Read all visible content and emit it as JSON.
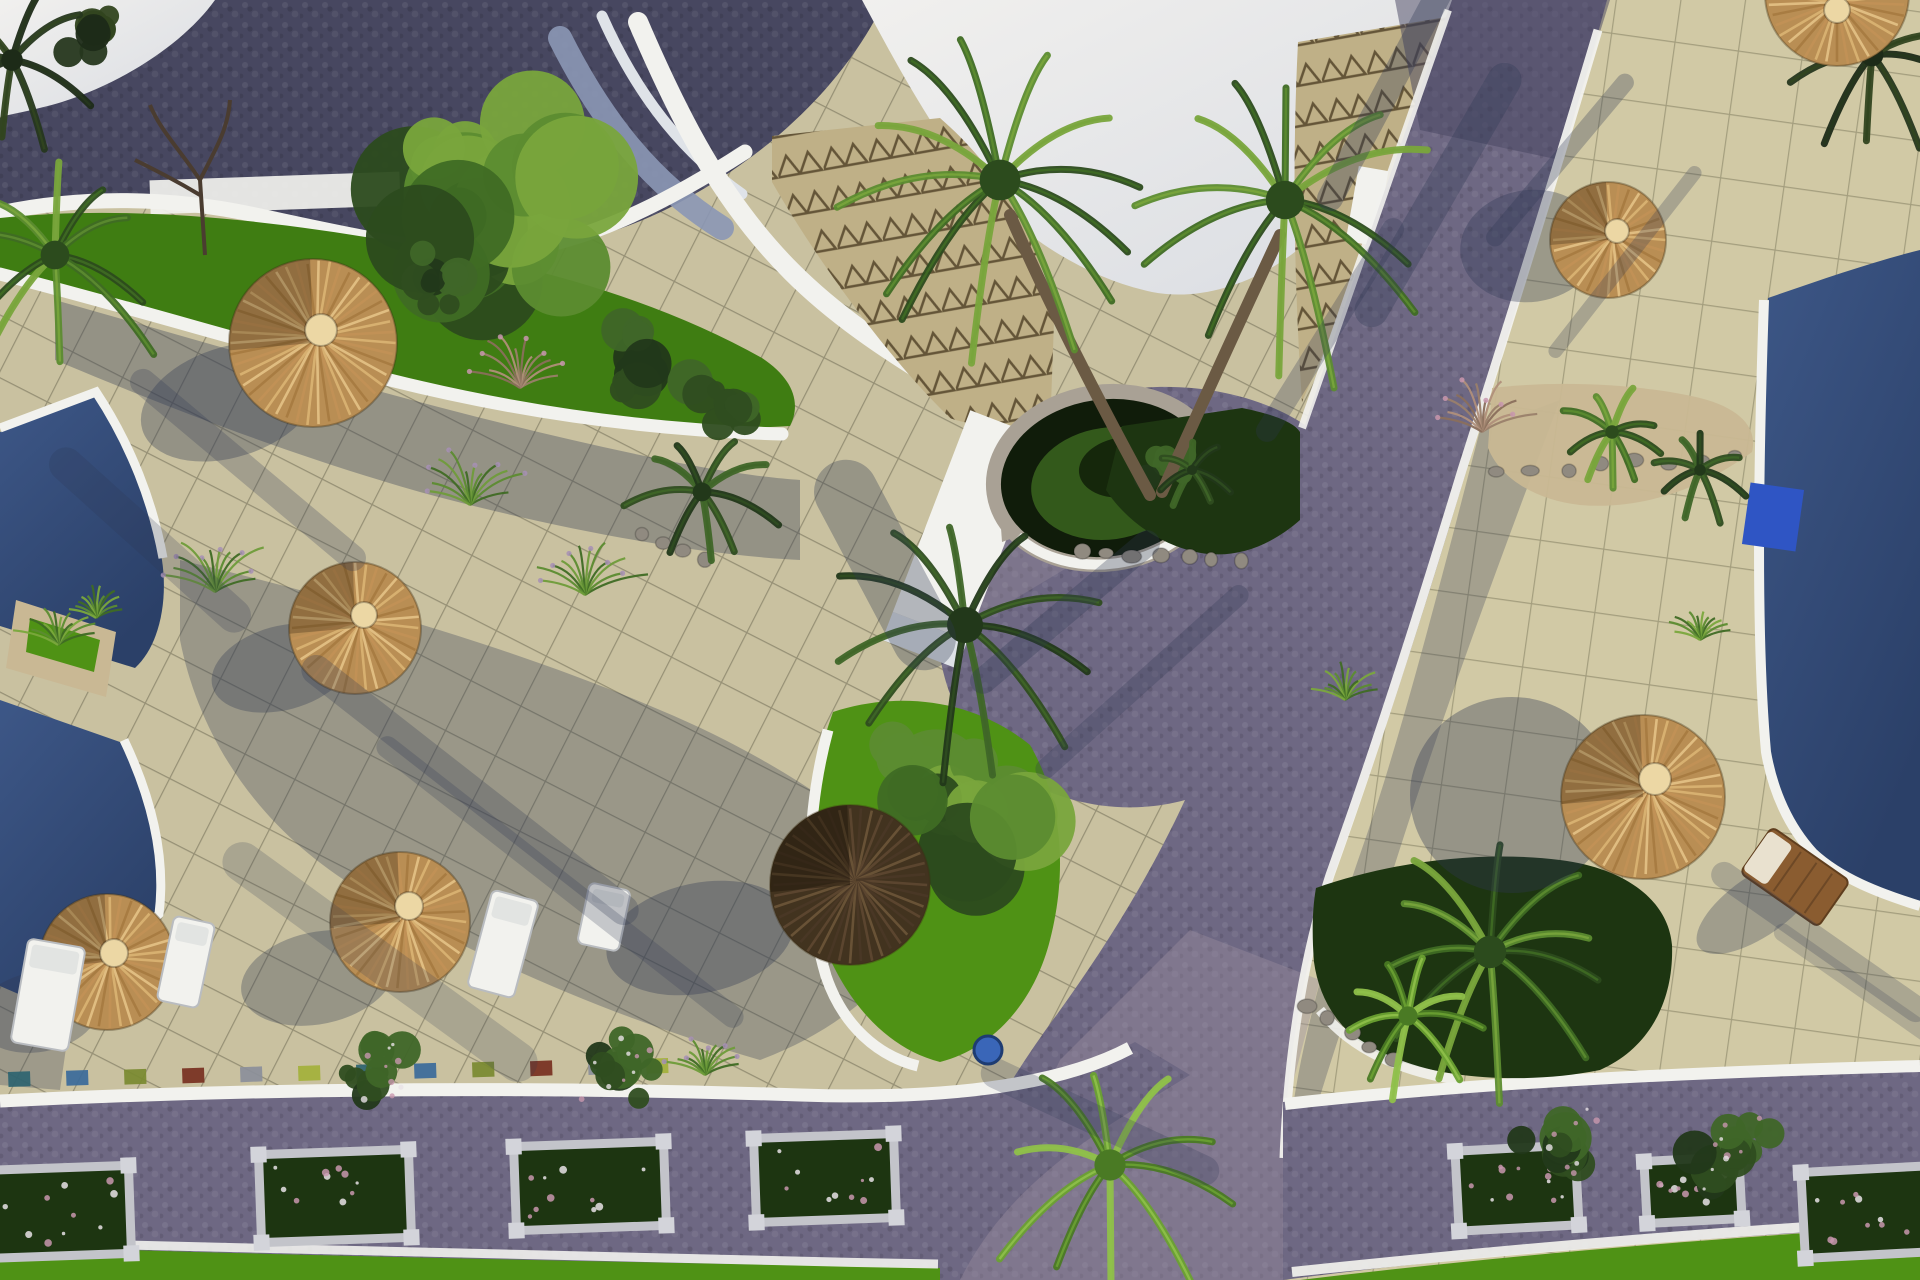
{
  "meta": {
    "type": "3d-aerial-architectural-render",
    "subject": "resort courtyard with pools, thatched umbrellas, paved terraces and cobble paths",
    "canvas": {
      "w": 1920,
      "h": 1280
    }
  },
  "palette": {
    "skyA": "#f1f0ee",
    "skyB": "#d9dce2",
    "roofDark": "#474760",
    "roofDot": "#5b5b73",
    "rampBlue": "#8b97b5",
    "rampWhite": "#dfe3e8",
    "white": "#f2f2ee",
    "whiteDim": "#ccd0d6",
    "tileL": "#c9c1a0",
    "tileR": "#d1c9a5",
    "gridL": "#6b6852",
    "gridR": "#787458",
    "shade": "#2f3752",
    "road": "#6e6883",
    "roadSun": "#9a8e9f",
    "roadDark": "#454360",
    "pool": "#2b4068",
    "poolHi": "#3d5787",
    "poolBox": "#2f55c4",
    "lawn": "#4f9215",
    "lawnDark": "#3f7d12",
    "sand": "#c9b894",
    "stone": "#a9a195",
    "rock": "#908a80",
    "bedDark": "#1d3511",
    "bushDark": "#27421a",
    "bushMid": "#3f6b24",
    "bushLight": "#6f9c3a",
    "bushPale": "#9ec455",
    "thatchBase": "#b98e54",
    "thatchHi": "#d9b272",
    "thatchMid": "#c29257",
    "thatchLo": "#a87c42",
    "thatchDarkBase": "#42331f",
    "cream": "#ecd7a4",
    "wood": "#8a5c30",
    "trunk": "#6b5a44",
    "twig": "#4a3c30",
    "zigBg": "#bfb087",
    "zigLine": "#645538",
    "frame": "#c3c4ca",
    "flowerPink": "#c897ae",
    "flowerWhite": "#e8e2e6",
    "potBlue": "#3a66b8"
  },
  "scene": {
    "umbrellas": [
      {
        "id": "thatch-umbrella-top-left",
        "cx": 313,
        "cy": 343,
        "r": 84,
        "tone": "bright",
        "hole": [
          8,
          -13,
          16
        ]
      },
      {
        "id": "thatch-umbrella-mid-left",
        "cx": 355,
        "cy": 628,
        "r": 66,
        "tone": "bright",
        "hole": [
          9,
          -13,
          13
        ]
      },
      {
        "id": "thatch-umbrella-center-shaded",
        "cx": 850,
        "cy": 885,
        "r": 80,
        "tone": "dark",
        "hole": [
          12,
          -10,
          10
        ]
      },
      {
        "id": "thatch-umbrella-bottom-left-1",
        "cx": 107,
        "cy": 962,
        "r": 68,
        "tone": "bright",
        "hole": [
          7,
          -9,
          14
        ]
      },
      {
        "id": "thatch-umbrella-bottom-left-2",
        "cx": 400,
        "cy": 922,
        "r": 70,
        "tone": "bright",
        "hole": [
          9,
          -16,
          14
        ]
      },
      {
        "id": "thatch-umbrella-right-lower",
        "cx": 1643,
        "cy": 797,
        "r": 82,
        "tone": "bright",
        "hole": [
          12,
          -18,
          16
        ]
      },
      {
        "id": "thatch-umbrella-right-upper",
        "cx": 1608,
        "cy": 240,
        "r": 58,
        "tone": "bright",
        "hole": [
          9,
          -9,
          12
        ]
      },
      {
        "id": "thatch-umbrella-top-corner",
        "cx": 1837,
        "cy": -6,
        "r": 72,
        "tone": "bright",
        "hole": [
          0,
          16,
          13
        ]
      }
    ],
    "umbrella_shadows": [
      [
        230,
        402,
        92,
        55,
        -18,
        0.34
      ],
      [
        282,
        668,
        72,
        42,
        -15,
        0.32
      ],
      [
        700,
        938,
        95,
        55,
        -12,
        0.34
      ],
      [
        38,
        1012,
        62,
        40,
        -10,
        0.3
      ],
      [
        318,
        978,
        78,
        46,
        -12,
        0.32
      ],
      [
        1512,
        795,
        102,
        98,
        0,
        0.36
      ],
      [
        1530,
        246,
        70,
        56,
        -8,
        0.33
      ],
      [
        1758,
        906,
        72,
        30,
        -35,
        0.3
      ]
    ],
    "palms": [
      {
        "id": "palm-cluster-main",
        "cx": 1000,
        "cy": 180,
        "r": 170,
        "n": 13,
        "tone": "mid"
      },
      {
        "id": "palm-cluster-east",
        "cx": 1285,
        "cy": 200,
        "r": 160,
        "n": 12,
        "tone": "mid"
      },
      {
        "id": "palm-court",
        "cx": 965,
        "cy": 625,
        "r": 150,
        "n": 11,
        "tone": "dark"
      },
      {
        "id": "palm-west-edge",
        "cx": 55,
        "cy": 255,
        "r": 120,
        "n": 10,
        "tone": "mid"
      },
      {
        "id": "palm-topleft-silhouette",
        "cx": 12,
        "cy": 60,
        "r": 90,
        "n": 8,
        "tone": "sil"
      },
      {
        "id": "palm-topright-corner",
        "cx": 1872,
        "cy": 55,
        "r": 95,
        "n": 9,
        "tone": "sil"
      },
      {
        "id": "palm-rock-planter-1",
        "cx": 1612,
        "cy": 432,
        "r": 56,
        "n": 9,
        "tone": "mid"
      },
      {
        "id": "palm-rock-planter-2",
        "cx": 1700,
        "cy": 470,
        "r": 48,
        "n": 8,
        "tone": "dark"
      },
      {
        "id": "palm-median-bed",
        "cx": 1192,
        "cy": 470,
        "r": 42,
        "n": 7,
        "tone": "dark"
      },
      {
        "id": "palm-right-bed-large",
        "cx": 1490,
        "cy": 952,
        "r": 135,
        "n": 11,
        "tone": "mid"
      },
      {
        "id": "palm-right-bed-small",
        "cx": 1408,
        "cy": 1016,
        "r": 80,
        "n": 9,
        "tone": "light"
      },
      {
        "id": "palm-junction",
        "cx": 1110,
        "cy": 1165,
        "r": 130,
        "n": 10,
        "tone": "light"
      },
      {
        "id": "palm-court-west",
        "cx": 702,
        "cy": 492,
        "r": 78,
        "n": 9,
        "tone": "dark"
      }
    ],
    "trunks": [
      [
        1150,
        495,
        1060,
        330,
        1010,
        215
      ],
      [
        1162,
        492,
        1240,
        320,
        1280,
        235
      ]
    ],
    "bushes": [
      {
        "id": "tree-upper-lawn",
        "cx": 470,
        "cy": 210,
        "r": 150,
        "n": 26,
        "tone": "mid"
      },
      {
        "id": "hedge-upper-1",
        "cx": 650,
        "cy": 365,
        "r": 62,
        "n": 12,
        "tone": "dark"
      },
      {
        "id": "hedge-upper-2",
        "cx": 735,
        "cy": 408,
        "r": 48,
        "n": 10,
        "tone": "dark"
      },
      {
        "id": "hedge-near-curb",
        "cx": 437,
        "cy": 278,
        "r": 48,
        "n": 10,
        "tone": "dark"
      },
      {
        "id": "bush-center-planter",
        "cx": 940,
        "cy": 800,
        "r": 118,
        "n": 20,
        "tone": "mid"
      },
      {
        "id": "tree-topleft-corner",
        "cx": 95,
        "cy": 30,
        "r": 48,
        "n": 9,
        "tone": "sil"
      },
      {
        "id": "bush-median-bed",
        "cx": 1160,
        "cy": 466,
        "r": 40,
        "n": 8,
        "tone": "dark"
      },
      {
        "id": "shrub-road-left-1",
        "cx": 380,
        "cy": 1072,
        "r": 46,
        "n": 9,
        "tone": "dark",
        "speck": true
      },
      {
        "id": "shrub-road-left-2",
        "cx": 620,
        "cy": 1068,
        "r": 52,
        "n": 9,
        "tone": "dark",
        "speck": true
      },
      {
        "id": "shrub-road-right-1",
        "cx": 1565,
        "cy": 1138,
        "r": 64,
        "n": 11,
        "tone": "dark",
        "speck": true
      },
      {
        "id": "shrub-road-right-2",
        "cx": 1735,
        "cy": 1152,
        "r": 62,
        "n": 11,
        "tone": "dark",
        "speck": true
      }
    ],
    "tufts": [
      {
        "id": "grass-planter-1",
        "x": 470,
        "y": 505,
        "len": 60,
        "type": "flower"
      },
      {
        "id": "grass-planter-2",
        "x": 585,
        "y": 595,
        "len": 62,
        "type": "flower"
      },
      {
        "id": "grass-pool-corner",
        "x": 215,
        "y": 592,
        "len": 66,
        "type": "flower"
      },
      {
        "id": "grass-dried",
        "x": 520,
        "y": 388,
        "len": 58,
        "type": "dried"
      },
      {
        "id": "grass-right-planter",
        "x": 1482,
        "y": 432,
        "len": 56,
        "type": "dried"
      },
      {
        "id": "grass-pool-wedge-1",
        "x": 58,
        "y": 645,
        "len": 44,
        "type": "green"
      },
      {
        "id": "grass-pool-wedge-2",
        "x": 96,
        "y": 618,
        "len": 40,
        "type": "green"
      },
      {
        "id": "grass-road-edge",
        "x": 1345,
        "y": 700,
        "len": 40,
        "type": "green"
      },
      {
        "id": "grass-bottom-terrace",
        "x": 705,
        "y": 1075,
        "len": 40,
        "type": "flower"
      },
      {
        "id": "grass-right-terrace",
        "x": 1700,
        "y": 640,
        "len": 34,
        "type": "green"
      }
    ],
    "loungers": [
      {
        "id": "sun-lounger-white-1",
        "cx": 48,
        "cy": 995,
        "w": 58,
        "h": 105,
        "rot": 10,
        "type": "white"
      },
      {
        "id": "sun-lounger-white-2",
        "cx": 186,
        "cy": 962,
        "w": 42,
        "h": 86,
        "rot": 12,
        "type": "white"
      },
      {
        "id": "sun-lounger-white-3",
        "cx": 503,
        "cy": 944,
        "w": 48,
        "h": 100,
        "rot": 15,
        "type": "white"
      },
      {
        "id": "sun-lounger-white-4",
        "cx": 604,
        "cy": 917,
        "w": 42,
        "h": 62,
        "rot": 12,
        "type": "white"
      },
      {
        "id": "sun-lounger-wood",
        "cx": 1795,
        "cy": 877,
        "w": 95,
        "h": 56,
        "rot": 35,
        "type": "wood"
      }
    ],
    "planter_boxes": [
      {
        "cx": 55,
        "cy": 1212,
        "w": 150,
        "h": 88,
        "rot": -2
      },
      {
        "cx": 335,
        "cy": 1196,
        "w": 150,
        "h": 88,
        "rot": -2
      },
      {
        "cx": 590,
        "cy": 1186,
        "w": 150,
        "h": 84,
        "rot": -2
      },
      {
        "cx": 825,
        "cy": 1178,
        "w": 140,
        "h": 84,
        "rot": -2
      },
      {
        "cx": 1517,
        "cy": 1188,
        "w": 120,
        "h": 80,
        "rot": -3
      },
      {
        "cx": 1693,
        "cy": 1190,
        "w": 95,
        "h": 62,
        "rot": -3
      },
      {
        "cx": 1868,
        "cy": 1212,
        "w": 130,
        "h": 86,
        "rot": -3
      }
    ],
    "mosaic_tiles": {
      "colors": [
        "#2e6470",
        "#3a6a9a",
        "#7a8a30",
        "#77301f",
        "#8b8f9a",
        "#a3b13a"
      ],
      "count": 12,
      "x0": 8,
      "step": 58,
      "y0": 1072,
      "slope": -1.2,
      "w": 22,
      "h": 15
    },
    "rock_rows": [
      {
        "a": [
          1085,
          548
        ],
        "b": [
          1238,
          562
        ],
        "k": 7
      },
      {
        "a": [
          1500,
          472
        ],
        "b": [
          1738,
          456
        ],
        "k": 8
      },
      {
        "a": [
          640,
          532
        ],
        "b": [
          702,
          556
        ],
        "k": 4
      },
      {
        "a": [
          1310,
          1008
        ],
        "b": [
          1390,
          1062
        ],
        "k": 5
      }
    ],
    "shadow_streaks": [
      [
        1385,
        95,
        260,
        -62,
        26,
        0.33
      ],
      [
        1438,
        195,
        300,
        -60,
        34,
        0.3
      ],
      [
        1330,
        330,
        260,
        -58,
        22,
        0.28
      ],
      [
        1560,
        160,
        220,
        -50,
        18,
        0.3
      ],
      [
        1625,
        262,
        240,
        -52,
        14,
        0.26
      ],
      [
        1065,
        612,
        240,
        -40,
        26,
        0.3
      ],
      [
        1142,
        682,
        280,
        -42,
        20,
        0.26
      ],
      [
        885,
        565,
        230,
        62,
        64,
        0.32
      ],
      [
        470,
        790,
        420,
        38,
        30,
        0.26
      ],
      [
        560,
        882,
        460,
        38,
        22,
        0.23
      ],
      [
        380,
        962,
        380,
        36,
        40,
        0.2
      ],
      [
        1100,
        1122,
        260,
        25,
        30,
        0.24
      ],
      [
        1820,
        942,
        260,
        35,
        26,
        0.24
      ],
      [
        1882,
        1002,
        260,
        35,
        18,
        0.2
      ],
      [
        248,
        470,
        300,
        40,
        26,
        0.25
      ],
      [
        150,
        540,
        260,
        42,
        34,
        0.22
      ]
    ],
    "pot": {
      "id": "blue-planter-pot",
      "cx": 988,
      "cy": 1050,
      "r": 14
    }
  }
}
